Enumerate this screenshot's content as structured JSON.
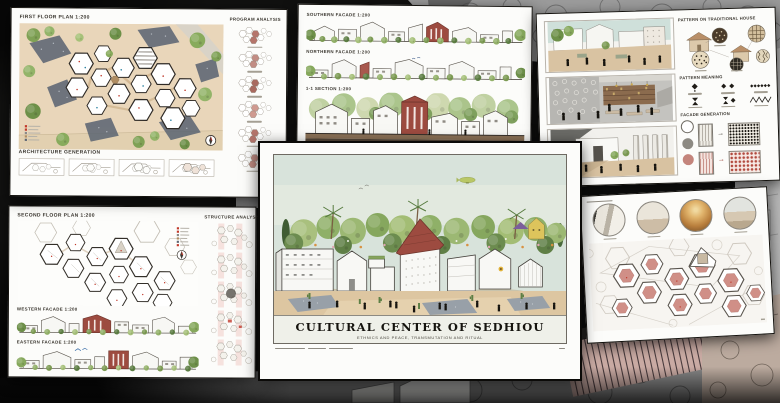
{
  "window": {
    "description": "Collage of six architectural presentation boards over a sketch backdrop"
  },
  "boards": {
    "first_floor": {
      "title": "FIRST FLOOR PLAN 1:200",
      "generation_label": "ARCHITECTURE GENERATION",
      "program_label": "PROGRAM ANALYSIS"
    },
    "facades": {
      "southern_label": "SOUTHERN FACADE 1:200",
      "northern_label": "NORTHERN FACADE 1:200",
      "section_label": "1-1 SECTION 1:200"
    },
    "patterns": {
      "traditional_house_label": "PATTERN ON TRADITIONAL HOUSE",
      "meaning_label": "PATTERN MEANING",
      "facade_generation_label": "FACADE GENERATION"
    },
    "second_floor": {
      "title": "SECOND FLOOR PLAN 1:200",
      "structure_label": "STRUCTURE ANALYSIS",
      "western_label": "WESTERN FACADE 1:200",
      "eastern_label": "EASTERN FACADE 1:200"
    },
    "main": {
      "title": "CULTURAL CENTER OF SEDHIOU",
      "subtitle": "ETHNICS AND PEACE, TRANSMUTATION AND RITUAL"
    }
  },
  "colors": {
    "accent_maroon": "#9d4b40",
    "accent_rose": "#c4857c",
    "foliage": "#7f9f58",
    "sand": "#e7d3b5",
    "sky": "#d7e3db",
    "paper": "#fcfcfa",
    "ink": "#211f1c",
    "gravel": "#5d6673"
  }
}
